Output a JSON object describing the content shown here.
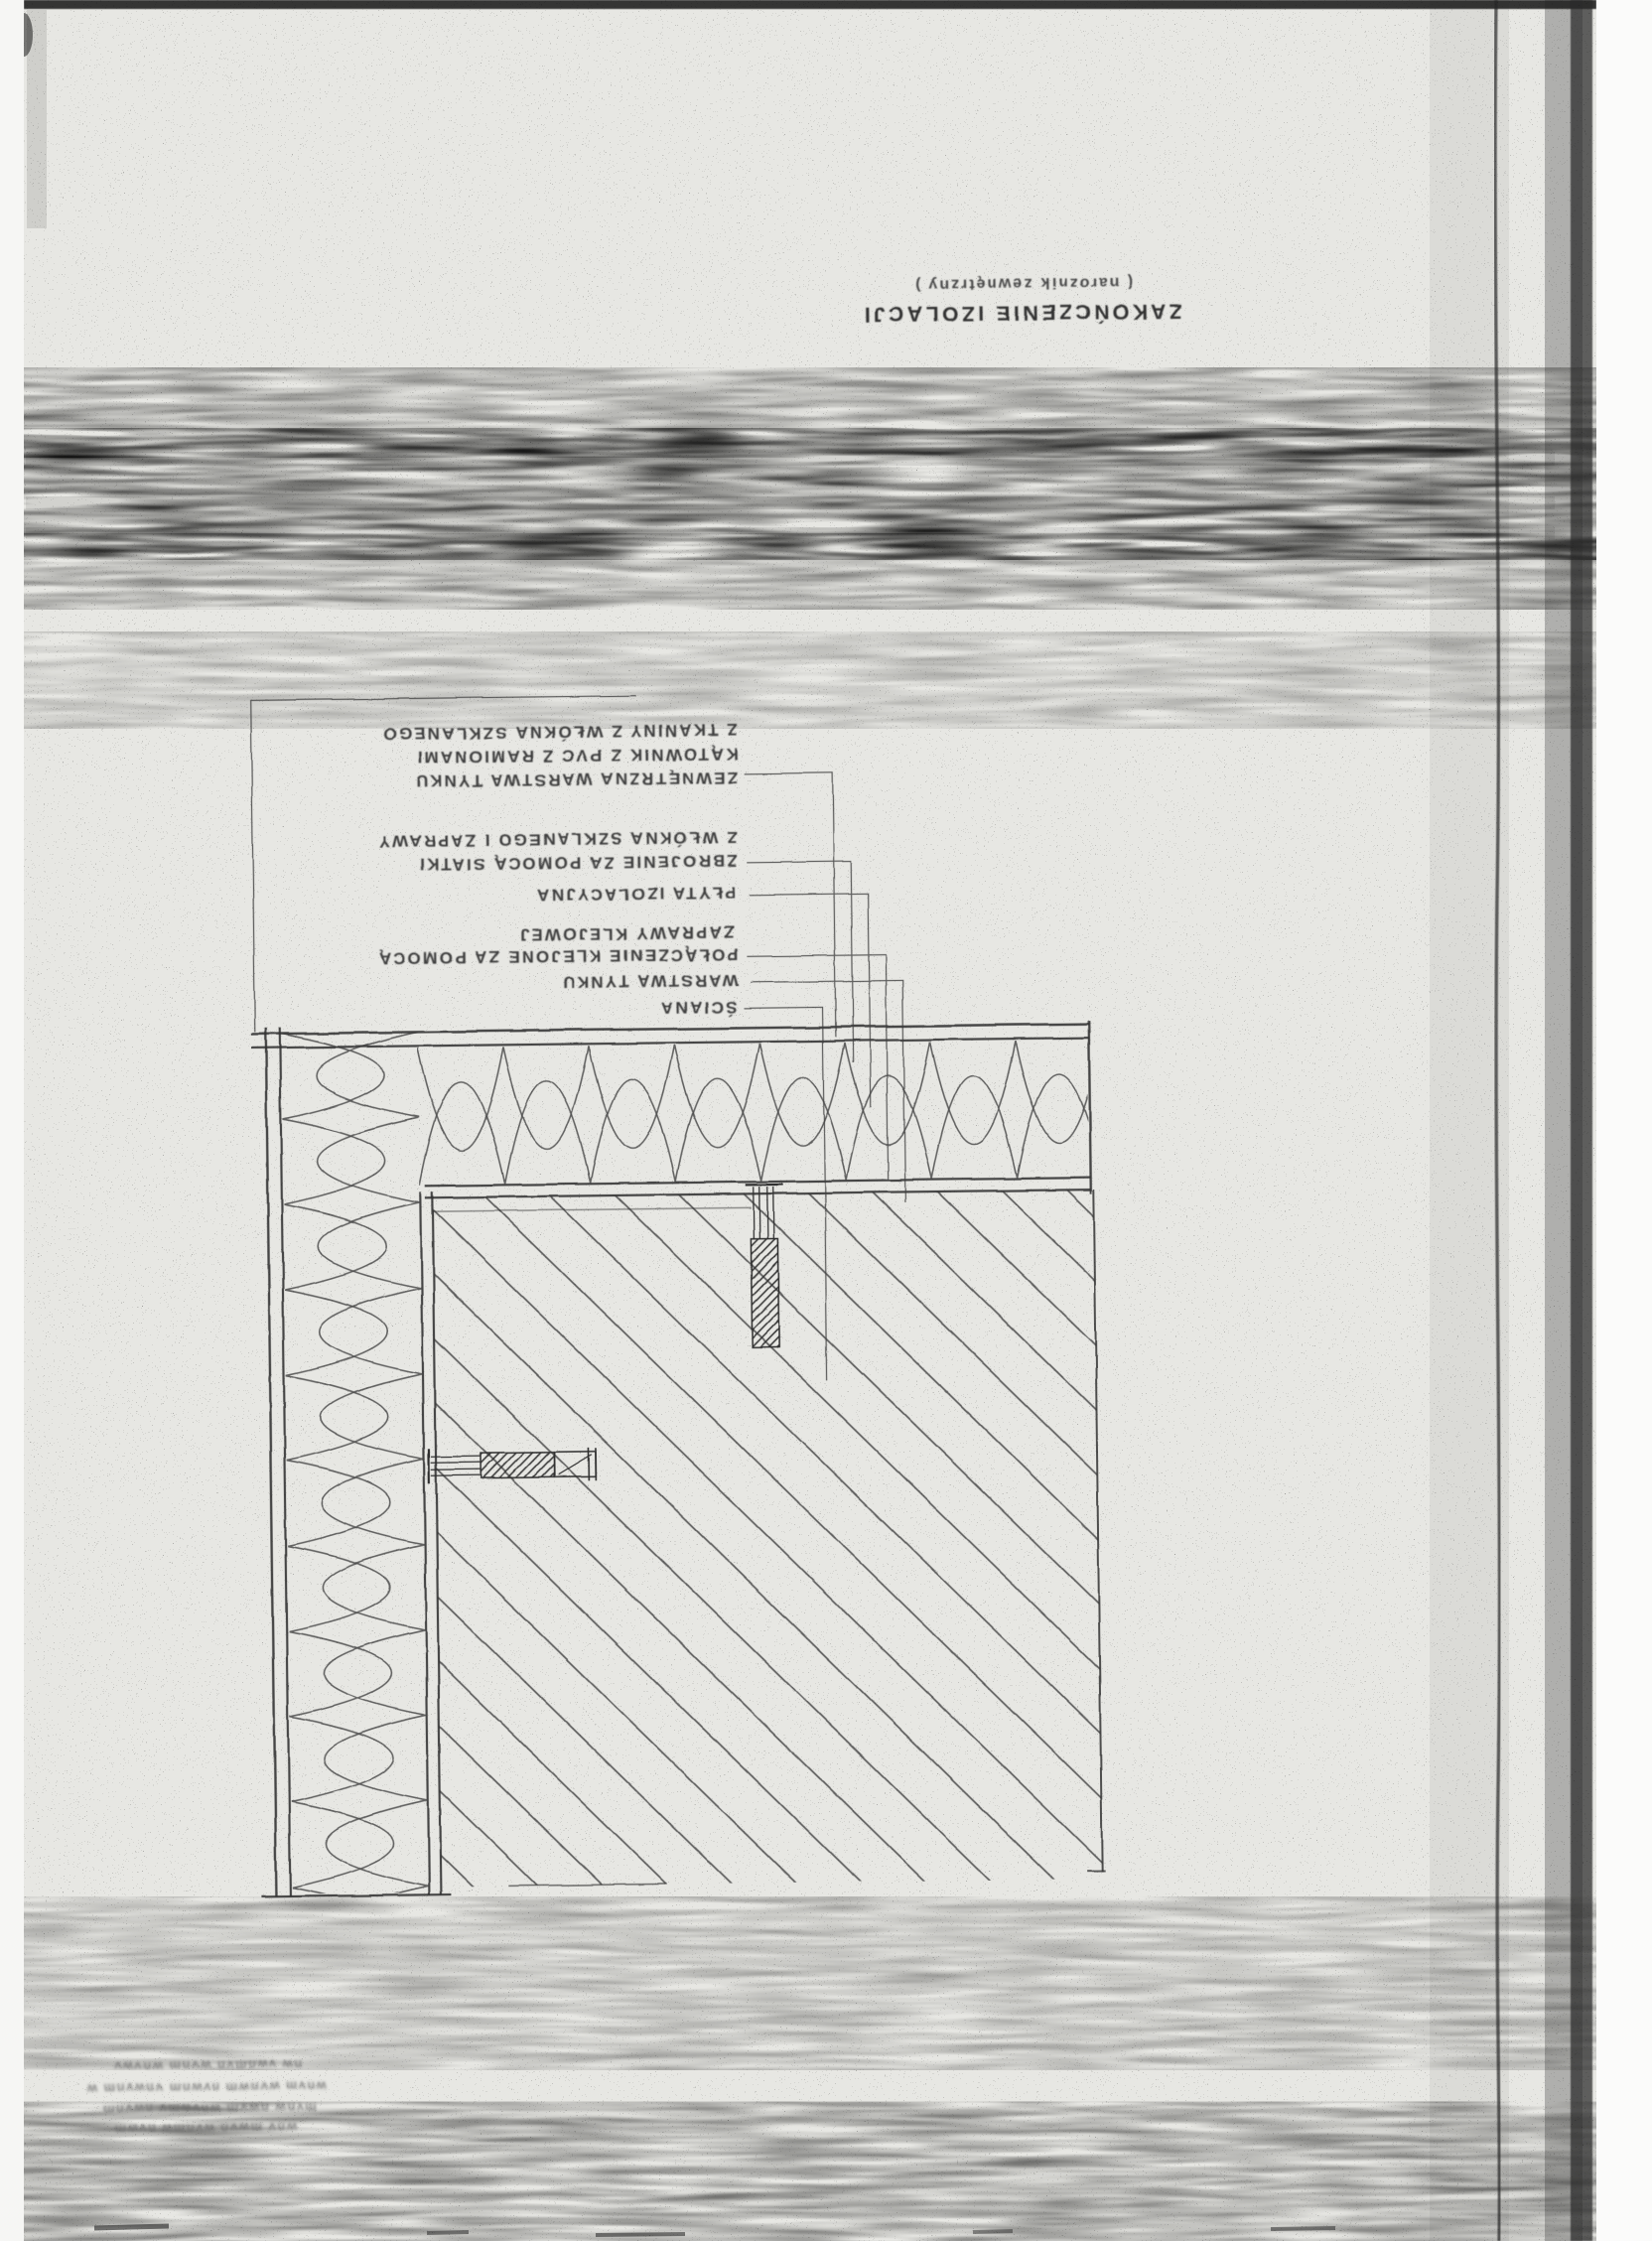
{
  "scan": {
    "title": {
      "subtitle": "( naroznik zewnętrzny )",
      "main": "ZAKOŃCZENIE IZOLACJI"
    },
    "callouts": [
      "Z TKANINY Z WŁÓKNA SZKLANEGO",
      "KĄTOWNIK Z PVC Z RAMIONAMI",
      "ZEWNĘTRZNA WARSTWA TYNKU",
      "Z WŁÓKNA SZKLANEGO I ZAPRAWY",
      "ZBROJENIE ZA POMOCĄ SIATKI",
      "PŁYTA IZOLACYJNA",
      "ZAPRAWY KLEJOWEJ",
      "POŁĄCZENIE KLEJONE ZA POMOCĄ",
      "WARSTWA TYNKU",
      "ŚCIANA"
    ],
    "stamp": [
      "nw vwnmvn wvnm wnvwv",
      "wnvm wvnwm nvwnm vnwvnm w",
      "mvnw nwvm wnvwmv nwvnm",
      "wnv mwvn wvnmw nvwm"
    ],
    "colors": {
      "paper": "#e7e7e3",
      "ink": "#3a3a3a"
    }
  }
}
